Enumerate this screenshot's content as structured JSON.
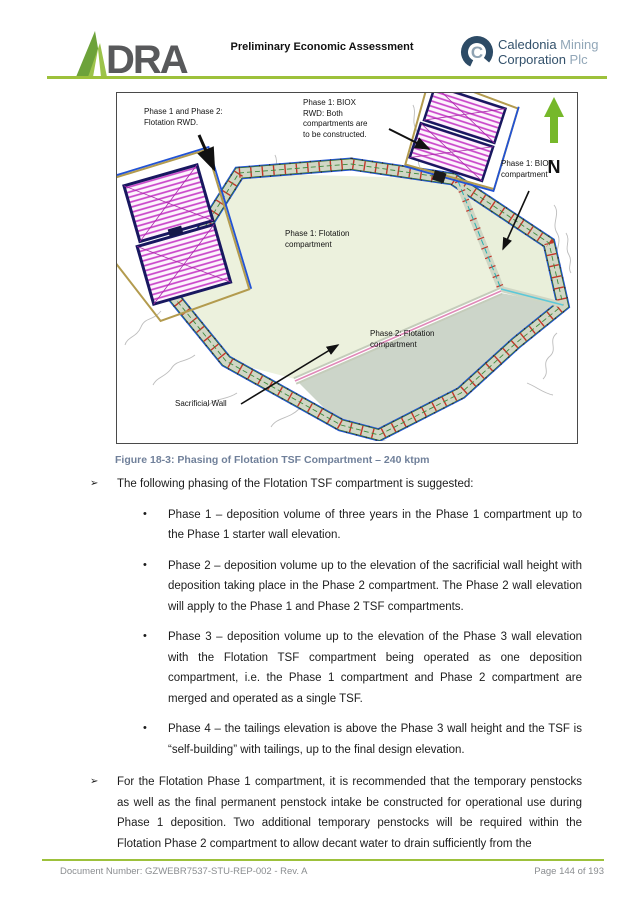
{
  "header": {
    "title": "Preliminary Economic Assessment",
    "dra_logo_text": "DRA",
    "caledonia": {
      "emblem_letter": "C",
      "line1_dark": "Caledonia",
      "line1_light": " Mining",
      "line2_dark": "Corporation",
      "line2_light": " Plc"
    }
  },
  "figure": {
    "caption": "Figure 18-3: Phasing of Flotation TSF Compartment – 240 ktpm",
    "north_label": "N",
    "labels": [
      {
        "id": "flotation-rwd",
        "text": "Phase 1 and Phase 2:\nFlotation RWD."
      },
      {
        "id": "biox-rwd",
        "text": "Phase 1: BIOX\nRWD: Both\ncompartments are\nto be constructed."
      },
      {
        "id": "biox-compartment",
        "text": "Phase 1: BIOX\ncompartment"
      },
      {
        "id": "phase1-flotation",
        "text": "Phase 1: Flotation\ncompartment"
      },
      {
        "id": "phase2-flotation",
        "text": "Phase 2: Flotation\ncompartment"
      },
      {
        "id": "sacrificial-wall",
        "text": "Sacrificial Wall"
      }
    ],
    "colors": {
      "phase1_fill": "#ecf1dd",
      "phase2_fill": "#ccd5c9",
      "biox_fill": "#e9efda",
      "embankment_gray": "#d0d7c5",
      "embankment_red_ticks": "#c3372a",
      "outer_blue_line": "#2253d4",
      "pond_hatch_magenta": "#c944c9",
      "pond_border_navy": "#181860",
      "pond_outline_tan": "#b39b4e",
      "north_arrow_green": "#76b82a"
    }
  },
  "content": {
    "arrow_marker": "➢",
    "bullet_marker": "•",
    "intro": "The following phasing of the Flotation TSF compartment is suggested:",
    "bullets": [
      "Phase 1 – deposition volume of three years in the Phase 1 compartment up to the Phase 1 starter wall elevation.",
      "Phase 2 – deposition volume up to the elevation of the sacrificial wall height with deposition taking place in the Phase 2 compartment. The Phase 2 wall elevation will apply to the Phase 1 and Phase 2 TSF compartments.",
      "Phase 3 – deposition volume up to the elevation of the Phase 3 wall elevation with the Flotation TSF compartment being operated as one deposition compartment, i.e. the Phase 1 compartment and Phase 2 compartment are merged and operated as a single TSF.",
      "Phase 4 – the tailings elevation is above the Phase 3 wall height and the TSF is “self-building” with tailings, up to the final design elevation."
    ],
    "second_paragraph": "For the Flotation Phase 1 compartment, it is recommended that the temporary penstocks as well as the final permanent penstock intake be constructed for operational use during Phase 1 deposition. Two additional temporary penstocks will be required within the Flotation Phase 2 compartment to allow decant water to drain sufficiently from the"
  },
  "footer": {
    "document_number": "Document Number: GZWEBR7537-STU-REP-002 - Rev. A",
    "page": "Page 144 of 193"
  }
}
